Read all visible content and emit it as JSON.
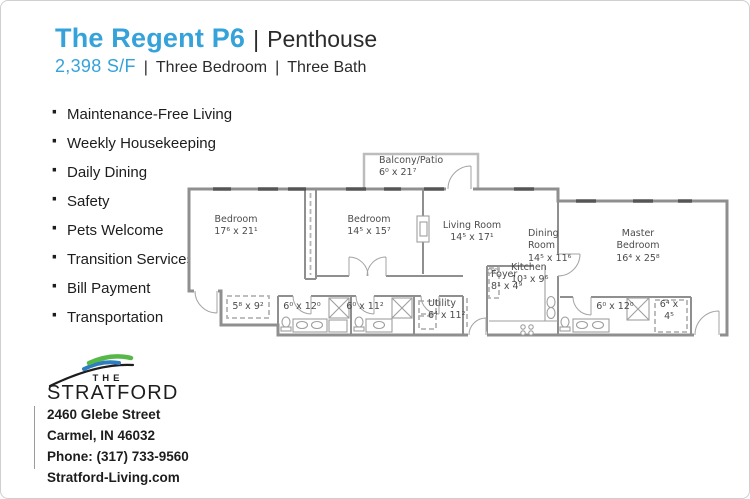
{
  "header": {
    "title": "The Regent P6",
    "pipe": "|",
    "unit_type": "Penthouse",
    "sqft": "2,398 S/F",
    "bedrooms": "Three Bedroom",
    "baths": "Three Bath"
  },
  "amenities": {
    "bullet": "·",
    "items": [
      "Maintenance-Free Living",
      "Weekly Housekeeping",
      "Daily Dining",
      "Safety",
      "Pets Welcome",
      "Transition Services",
      "Bill Payment",
      "Transportation"
    ]
  },
  "floorplan": {
    "rooms": [
      {
        "name": "Balcony/Patio",
        "dims": "6⁰ x 21⁷"
      },
      {
        "name": "Bedroom",
        "dims": "17⁶ x 21¹"
      },
      {
        "name": "Bedroom",
        "dims": "14⁵ x 15⁷"
      },
      {
        "name": "Living Room",
        "dims": "14⁵ x 17¹"
      },
      {
        "name": "Dining Room",
        "dims": "14⁵ x 11⁶"
      },
      {
        "name": "Kitchen",
        "dims": "10³ x 9⁶"
      },
      {
        "name": "Foyer",
        "dims": "8¹ x 4⁹"
      },
      {
        "name": "Master Bedroom",
        "dims": "16⁴ x 25⁸"
      },
      {
        "name": "",
        "dims": "5⁸ x 9²"
      },
      {
        "name": "",
        "dims": "6⁰ x 12⁰"
      },
      {
        "name": "",
        "dims": "6⁰ x 11²"
      },
      {
        "name": "Utility",
        "dims": "6⁴ x 11²"
      },
      {
        "name": "",
        "dims": "6⁰ x 12⁰"
      },
      {
        "name": "",
        "dims": "6⁴ x 4⁵"
      }
    ]
  },
  "logo": {
    "the": "THE",
    "name": "STRATFORD"
  },
  "contact": {
    "street": "2460 Glebe Street",
    "city": "Carmel, IN 46032",
    "phone": "Phone: (317) 733-9560",
    "website": "Stratford-Living.com"
  },
  "colors": {
    "accent_blue": "#35A2DA",
    "logo_green": "#56B847",
    "logo_blue": "#2E7DBE",
    "text_dark": "#1D1D1D",
    "wall_gray": "#8F8F8F",
    "window_gray": "#555555"
  }
}
